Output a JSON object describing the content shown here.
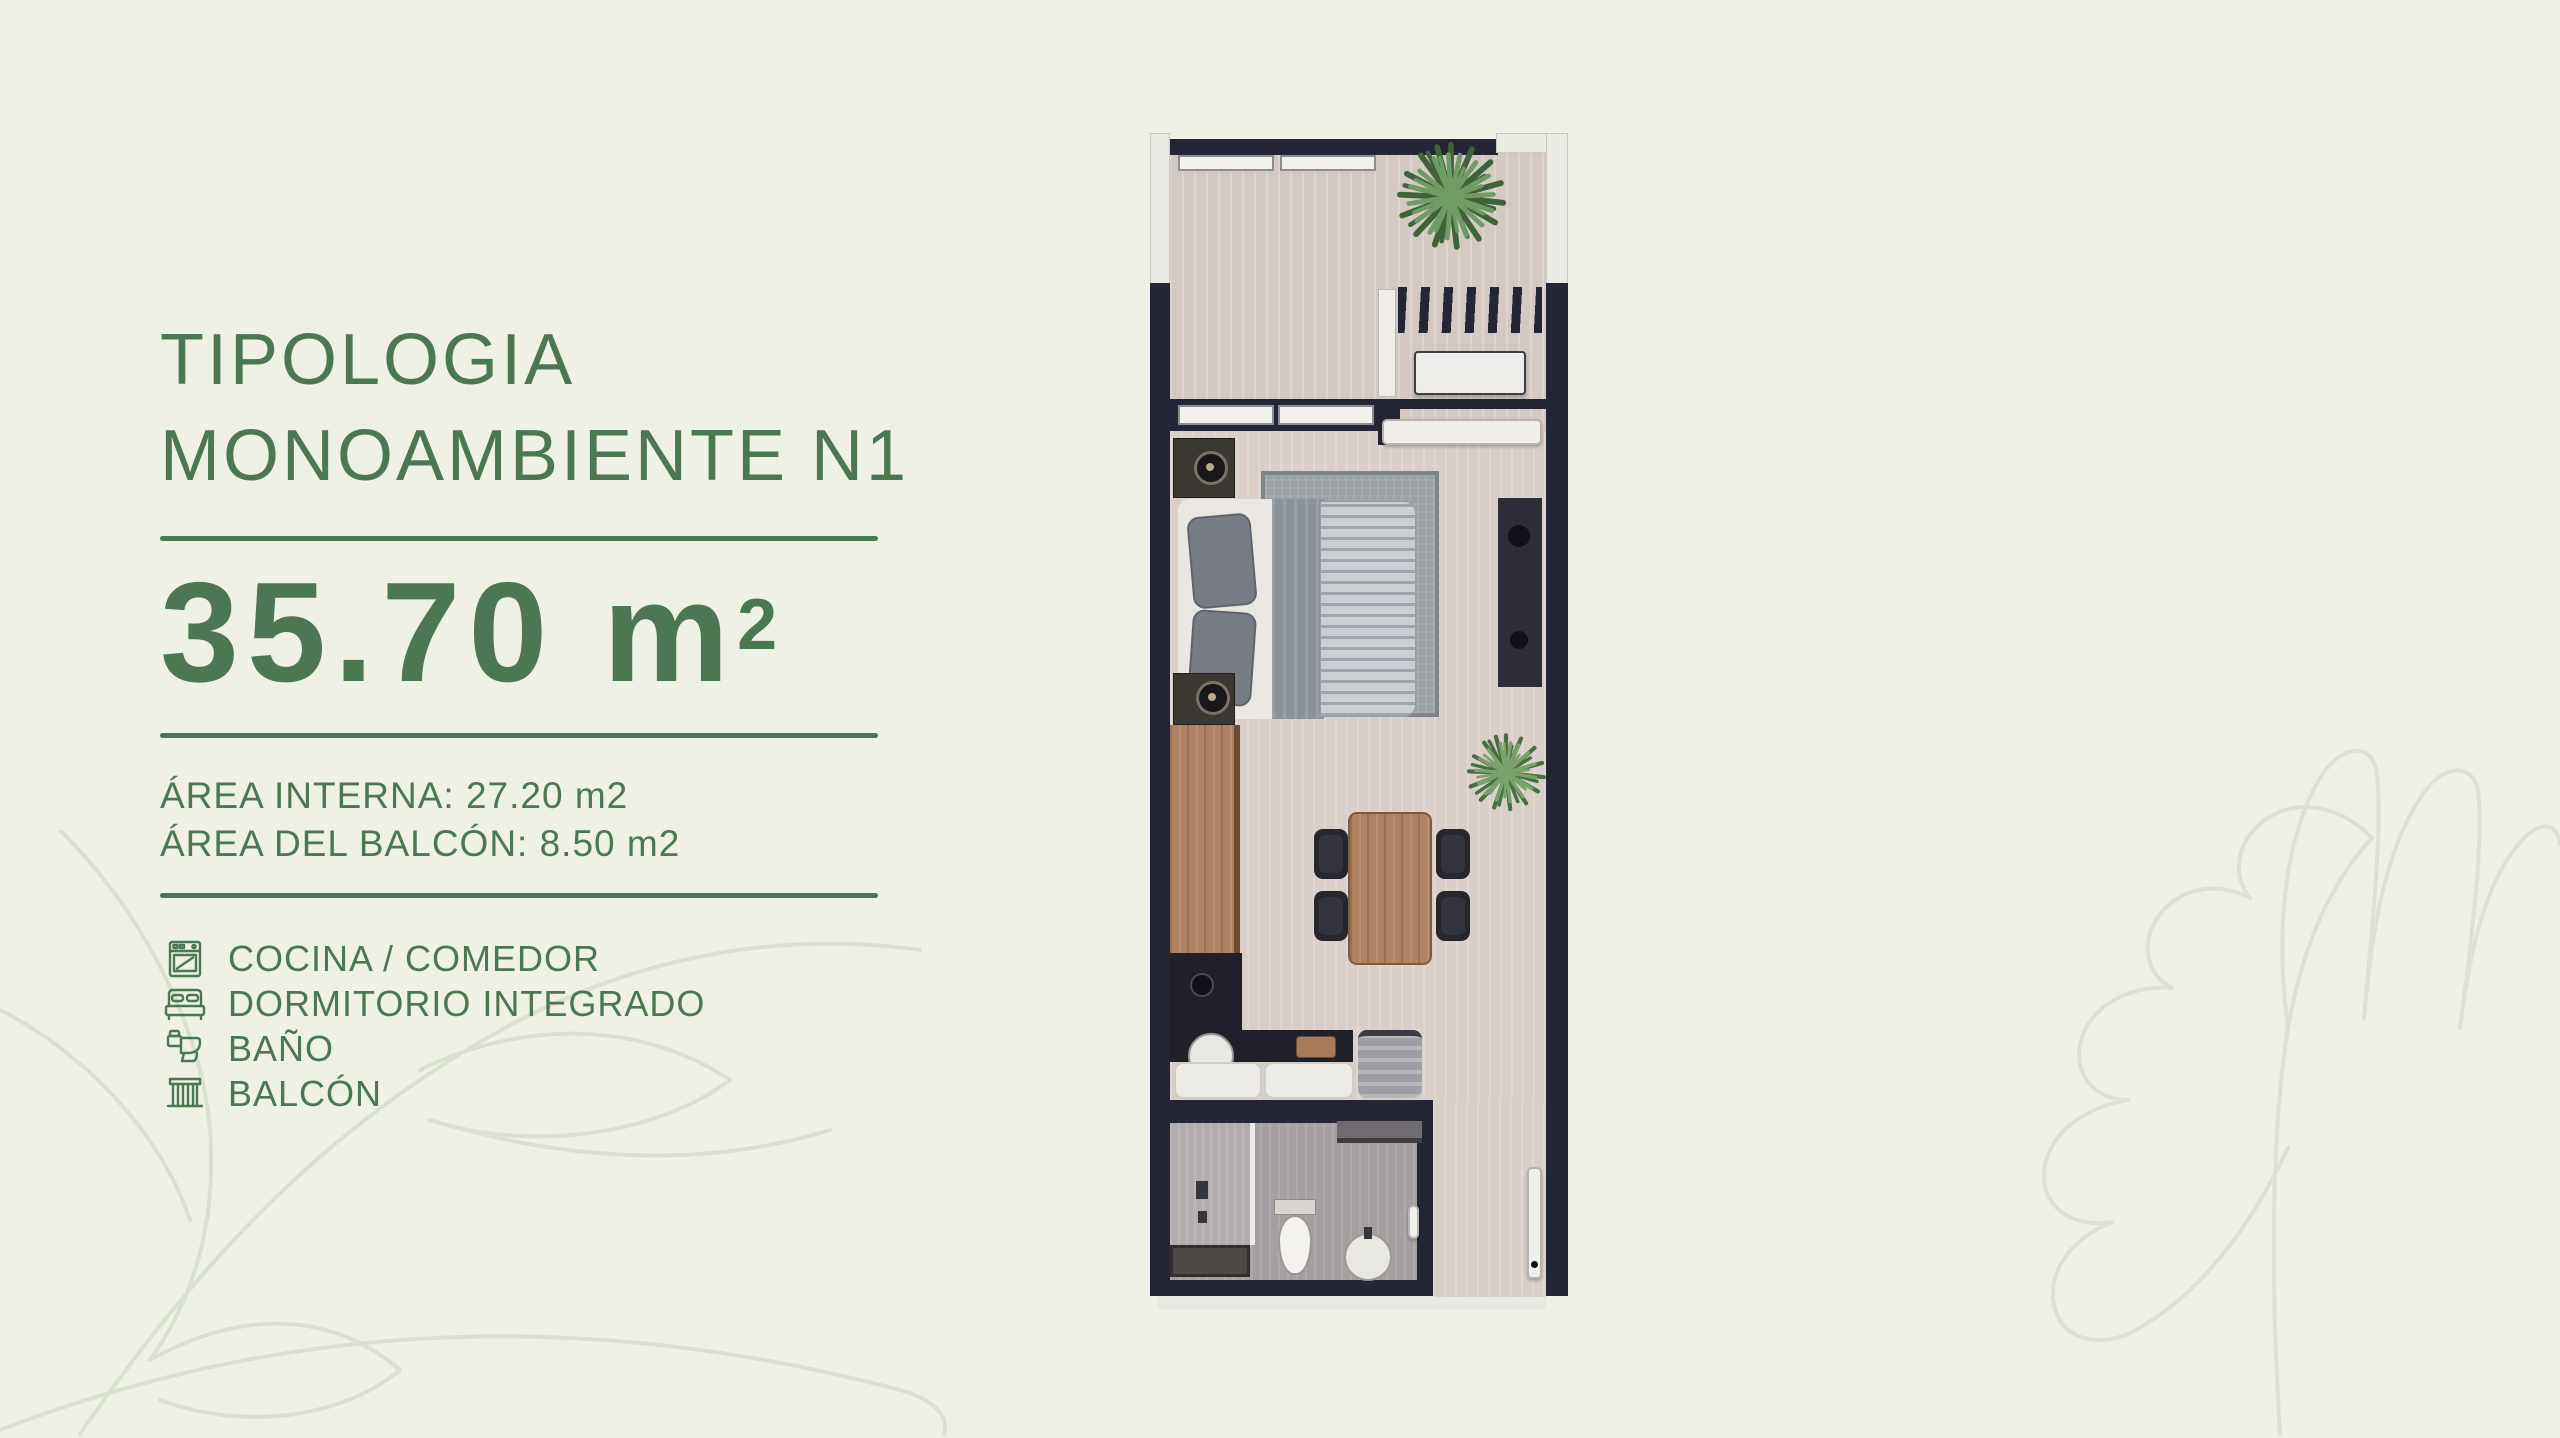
{
  "page": {
    "background": "#f0f1e6",
    "accent_green": "#4b7752",
    "watermark_color": "#dde0d1"
  },
  "panel": {
    "title_line1": "TIPOLOGIA",
    "title_line2": "MONOAMBIENTE N1",
    "area_value": "35.70 m",
    "area_sup": "2",
    "area_internal": "ÁREA INTERNA: 27.20 m2",
    "area_balcony": "ÁREA DEL BALCÓN: 8.50 m2",
    "legend": [
      {
        "icon": "stove-icon",
        "label": "COCINA / COMEDOR"
      },
      {
        "icon": "bed-icon",
        "label": "DORMITORIO INTEGRADO"
      },
      {
        "icon": "toilet-icon",
        "label": "BAÑO"
      },
      {
        "icon": "balcony-icon",
        "label": "BALCÓN"
      }
    ]
  },
  "floorplan": {
    "colors": {
      "wall": "#242636",
      "balcony_floor": "#d4c8c3",
      "bedroom_floor": "#d9cec8",
      "bathroom_floor": "#a59fa2",
      "wood": "#b08264",
      "plant_green": "#4d7445"
    }
  }
}
